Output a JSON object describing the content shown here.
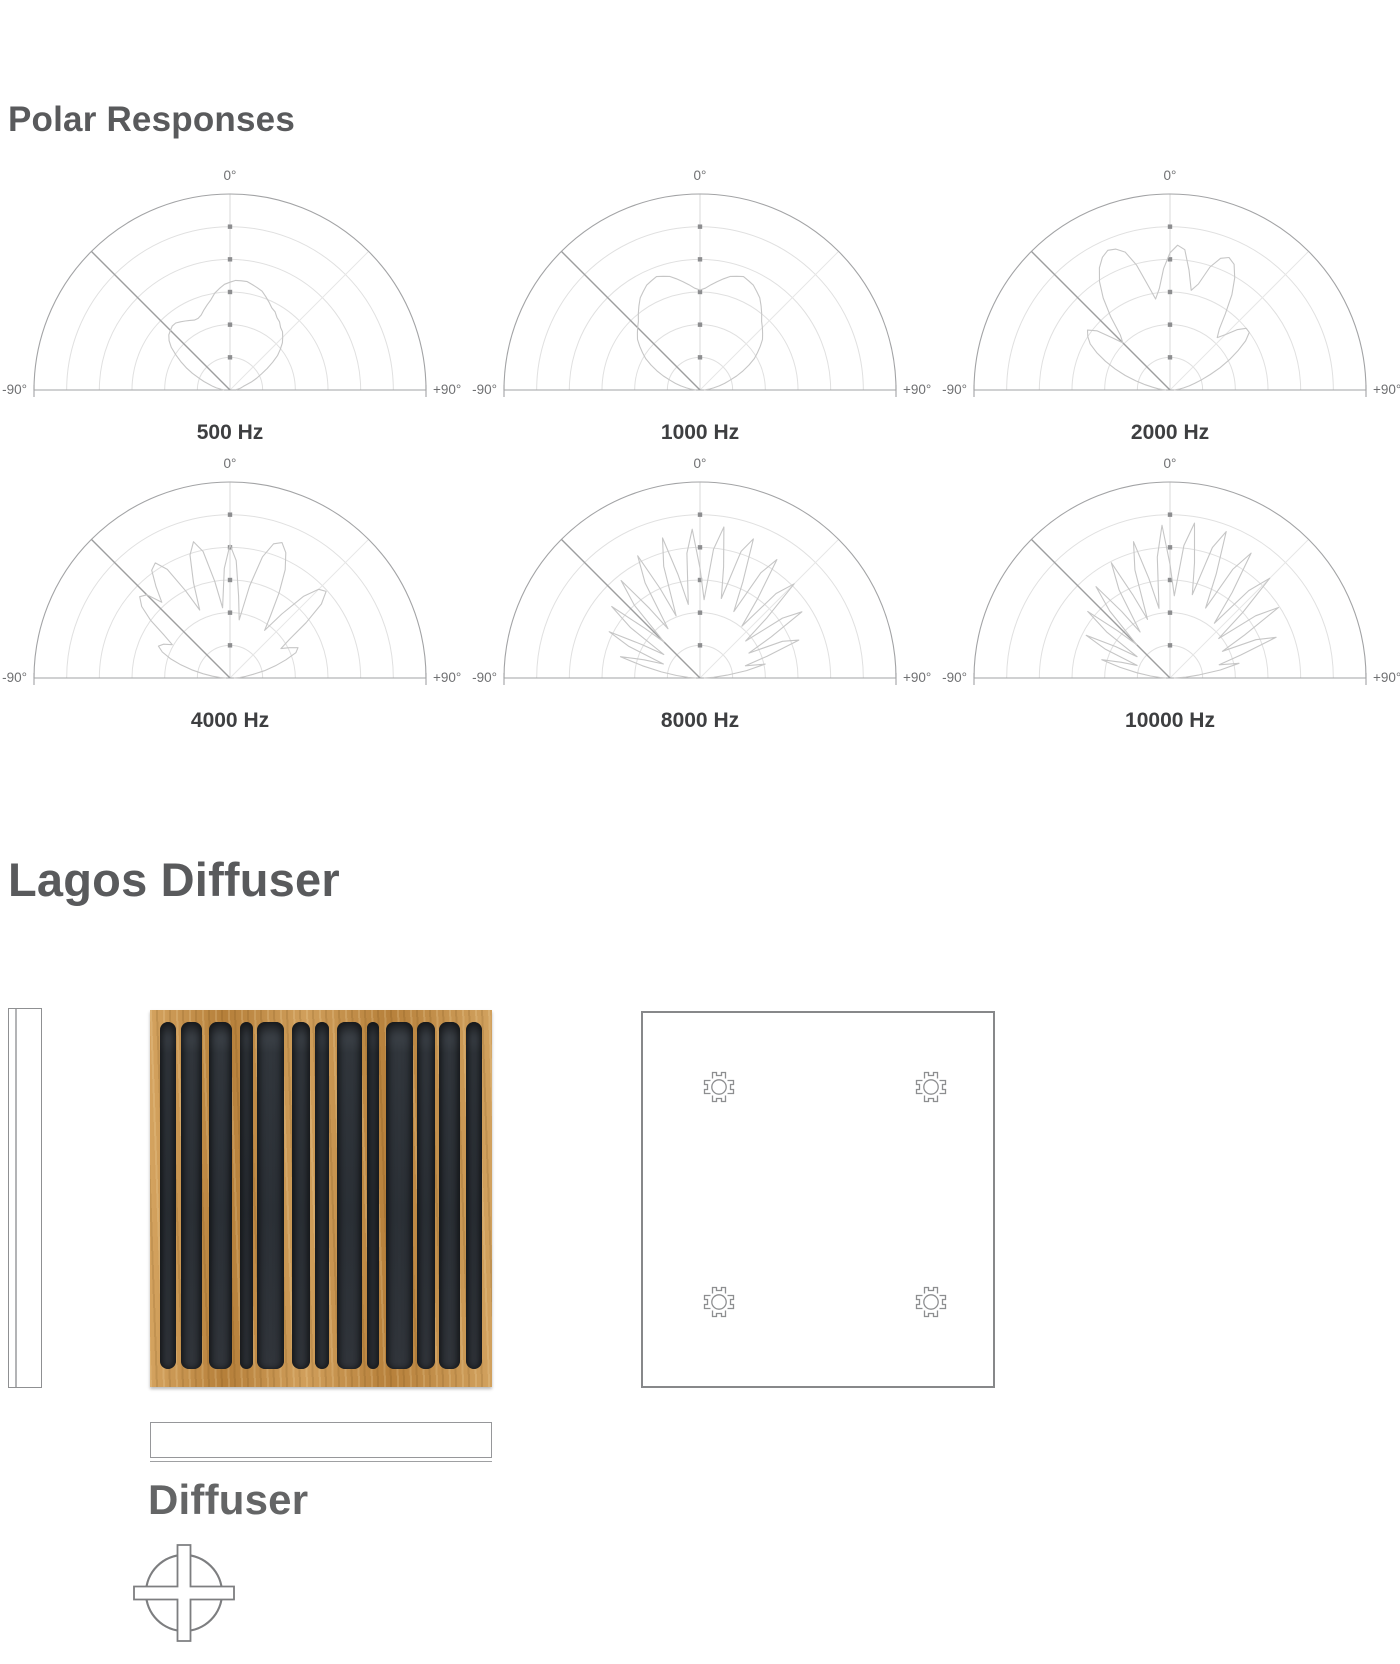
{
  "page": {
    "background": "#ffffff"
  },
  "sections": {
    "polar": {
      "title": "Polar Responses"
    },
    "product": {
      "title": "Lagos Diffuser",
      "drawing_label": "Diffuser"
    }
  },
  "polar_chrome": {
    "top_label": "0°",
    "left_label": "-90°",
    "right_label": "+90°",
    "ring_count": 6,
    "axis_tick_count": 5,
    "colors": {
      "outline": "#a2a3a5",
      "ring": "#e0e0e0",
      "axis": "#d8d8d8",
      "radial_faint": "#e7e7e7",
      "diagonal_marker": "#9d9e9f",
      "tick": "#8d8e90",
      "curve": "#c6c6c6",
      "degree_label": "#6f7072",
      "freq_label": "#3e3f41"
    }
  },
  "chart_data": {
    "type": "line",
    "subtype": "polar-half",
    "title": "Polar Responses",
    "legend_position": "none",
    "grid": true,
    "angle_axis": {
      "unit": "deg",
      "start": -90,
      "end": 90,
      "step": 3,
      "labels": [
        "-90°",
        "0°",
        "+90°"
      ]
    },
    "radial_axis": {
      "rings": 6,
      "normalized_max": 1
    },
    "series": [
      {
        "name": "500 Hz",
        "r": [
          0.03,
          0.04,
          0.05,
          0.07,
          0.09,
          0.11,
          0.14,
          0.17,
          0.21,
          0.25,
          0.29,
          0.33,
          0.37,
          0.4,
          0.42,
          0.43,
          0.44,
          0.44,
          0.43,
          0.42,
          0.41,
          0.4,
          0.4,
          0.41,
          0.43,
          0.45,
          0.47,
          0.5,
          0.52,
          0.54,
          0.55,
          0.56,
          0.56,
          0.56,
          0.55,
          0.54,
          0.53,
          0.51,
          0.49,
          0.47,
          0.46,
          0.44,
          0.43,
          0.41,
          0.4,
          0.38,
          0.36,
          0.33,
          0.3,
          0.26,
          0.22,
          0.18,
          0.15,
          0.12,
          0.09,
          0.07,
          0.06,
          0.05,
          0.04,
          0.03,
          0.03
        ]
      },
      {
        "name": "1000 Hz",
        "r": [
          0.02,
          0.03,
          0.05,
          0.07,
          0.1,
          0.13,
          0.16,
          0.2,
          0.24,
          0.28,
          0.32,
          0.35,
          0.38,
          0.41,
          0.43,
          0.45,
          0.47,
          0.5,
          0.53,
          0.56,
          0.58,
          0.6,
          0.61,
          0.62,
          0.61,
          0.6,
          0.58,
          0.56,
          0.54,
          0.52,
          0.51,
          0.52,
          0.54,
          0.56,
          0.58,
          0.6,
          0.61,
          0.62,
          0.61,
          0.6,
          0.58,
          0.56,
          0.53,
          0.5,
          0.47,
          0.45,
          0.43,
          0.41,
          0.38,
          0.35,
          0.32,
          0.28,
          0.24,
          0.2,
          0.16,
          0.13,
          0.1,
          0.07,
          0.05,
          0.03,
          0.02
        ]
      },
      {
        "name": "2000 Hz",
        "r": [
          0.02,
          0.04,
          0.06,
          0.09,
          0.13,
          0.18,
          0.24,
          0.3,
          0.36,
          0.42,
          0.47,
          0.5,
          0.52,
          0.48,
          0.4,
          0.34,
          0.38,
          0.48,
          0.58,
          0.66,
          0.72,
          0.76,
          0.78,
          0.77,
          0.74,
          0.66,
          0.55,
          0.47,
          0.52,
          0.62,
          0.7,
          0.74,
          0.72,
          0.62,
          0.52,
          0.56,
          0.66,
          0.72,
          0.74,
          0.72,
          0.66,
          0.58,
          0.48,
          0.4,
          0.36,
          0.4,
          0.46,
          0.5,
          0.5,
          0.46,
          0.4,
          0.34,
          0.28,
          0.22,
          0.17,
          0.13,
          0.1,
          0.07,
          0.05,
          0.03,
          0.02
        ]
      },
      {
        "name": "4000 Hz",
        "r": [
          0.02,
          0.05,
          0.09,
          0.14,
          0.2,
          0.26,
          0.32,
          0.37,
          0.4,
          0.38,
          0.34,
          0.4,
          0.5,
          0.58,
          0.62,
          0.6,
          0.52,
          0.6,
          0.68,
          0.7,
          0.64,
          0.5,
          0.38,
          0.52,
          0.66,
          0.72,
          0.66,
          0.5,
          0.36,
          0.56,
          0.68,
          0.6,
          0.42,
          0.3,
          0.48,
          0.64,
          0.72,
          0.74,
          0.7,
          0.62,
          0.5,
          0.38,
          0.3,
          0.42,
          0.56,
          0.64,
          0.66,
          0.6,
          0.48,
          0.36,
          0.3,
          0.34,
          0.38,
          0.36,
          0.3,
          0.24,
          0.18,
          0.12,
          0.08,
          0.05,
          0.02
        ]
      },
      {
        "name": "8000 Hz",
        "r": [
          0.02,
          0.06,
          0.12,
          0.2,
          0.3,
          0.42,
          0.3,
          0.2,
          0.4,
          0.52,
          0.34,
          0.22,
          0.44,
          0.58,
          0.38,
          0.26,
          0.5,
          0.64,
          0.44,
          0.3,
          0.56,
          0.7,
          0.5,
          0.34,
          0.6,
          0.74,
          0.54,
          0.38,
          0.64,
          0.76,
          0.56,
          0.4,
          0.66,
          0.78,
          0.58,
          0.42,
          0.68,
          0.76,
          0.54,
          0.38,
          0.62,
          0.72,
          0.5,
          0.34,
          0.58,
          0.68,
          0.46,
          0.3,
          0.52,
          0.62,
          0.42,
          0.28,
          0.46,
          0.54,
          0.36,
          0.24,
          0.34,
          0.24,
          0.14,
          0.07,
          0.02
        ]
      },
      {
        "name": "10000 Hz",
        "r": [
          0.02,
          0.05,
          0.1,
          0.17,
          0.26,
          0.36,
          0.26,
          0.18,
          0.36,
          0.48,
          0.32,
          0.2,
          0.4,
          0.54,
          0.36,
          0.24,
          0.46,
          0.6,
          0.42,
          0.28,
          0.52,
          0.66,
          0.46,
          0.32,
          0.58,
          0.72,
          0.52,
          0.36,
          0.62,
          0.78,
          0.58,
          0.42,
          0.68,
          0.8,
          0.6,
          0.44,
          0.7,
          0.8,
          0.58,
          0.4,
          0.64,
          0.76,
          0.54,
          0.36,
          0.6,
          0.72,
          0.5,
          0.32,
          0.54,
          0.66,
          0.44,
          0.3,
          0.48,
          0.58,
          0.38,
          0.26,
          0.36,
          0.26,
          0.15,
          0.08,
          0.02
        ]
      }
    ]
  },
  "diffuser_panel": {
    "wood_color": "#c18a43",
    "slot_color": "#2c3136",
    "border": {
      "left": 10,
      "right": 10,
      "top": 12,
      "bottom": 18
    },
    "slot_widths": [
      18,
      24,
      26,
      14,
      30,
      20,
      16,
      28,
      14,
      30,
      20,
      24,
      18
    ],
    "gap_widths": [
      5,
      7,
      9,
      5,
      8,
      6,
      8,
      5,
      7,
      5,
      4,
      6
    ]
  },
  "technical_drawing": {
    "symbol": "t-slot-extrusion-profile",
    "stroke": "#8d8e90",
    "positions": [
      {
        "fx": 0.215,
        "fy": 0.196
      },
      {
        "fx": 0.813,
        "fy": 0.196
      },
      {
        "fx": 0.215,
        "fy": 0.767
      },
      {
        "fx": 0.813,
        "fy": 0.767
      }
    ]
  },
  "section_symbol": {
    "stroke": "#7d7e80"
  }
}
